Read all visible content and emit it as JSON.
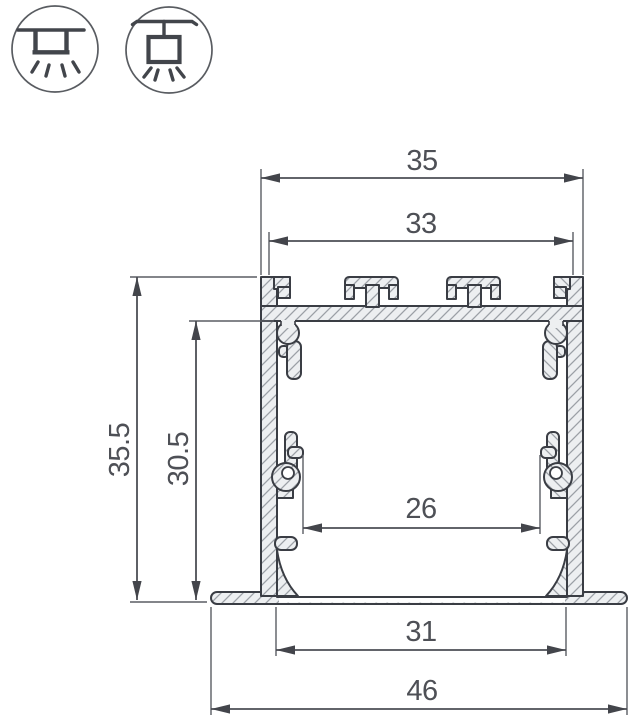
{
  "drawing": {
    "kind": "aluminum-led-profile-cross-section",
    "dims": {
      "top_outer": "35",
      "top_inner": "33",
      "outer_height": "35.5",
      "inner_height": "30.5",
      "inner_width": "26",
      "bottom_body": "31",
      "bottom_flange": "46"
    }
  },
  "legend": {
    "icon1": "recessed-mount-icon",
    "icon2": "surface-mount-icon"
  },
  "colors": {
    "outline": "#3a3d44",
    "metal_fill": "#edeff1",
    "hatch": "#9ba0a6",
    "dimension": "#4c4e54",
    "icon_stroke": "#42454b",
    "circle_stroke": "#595c61"
  }
}
